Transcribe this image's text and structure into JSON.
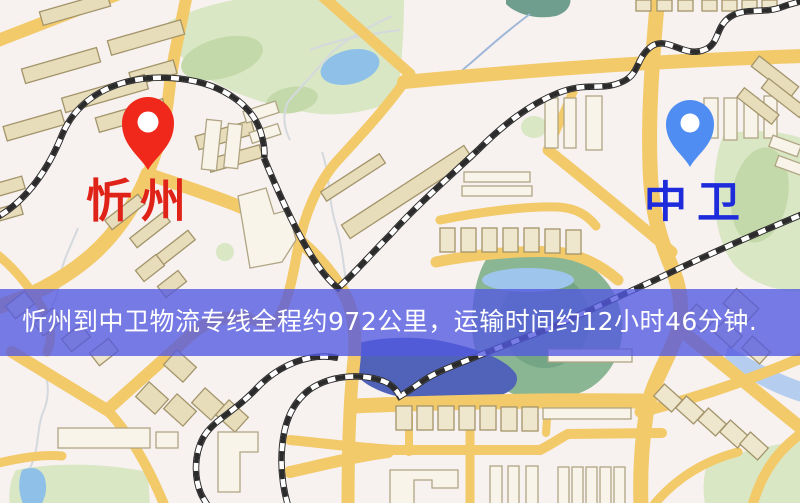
{
  "map": {
    "type": "city-street-map",
    "palette": {
      "background": "#f7f1ef",
      "road": "#f3ca6a",
      "building_fill": "#e7ddbb",
      "building_light": "#f8f4ea",
      "building_outline": "#a3946a",
      "park": "#d9e7c4",
      "park_dark": "#8ab694",
      "pond": "#8fc0e8",
      "lake": "#5063b8",
      "railway": "#2b2b2b"
    }
  },
  "origin_marker": {
    "label": "忻州",
    "label_color": "#e02318",
    "pin_color": "#f0281c"
  },
  "destination_marker": {
    "label": "中卫",
    "label_color": "#1e2bdb",
    "pin_color": "#4f8df2"
  },
  "banner": {
    "text": "忻州到中卫物流专线全程约972公里，运输时间约12小时46分钟.",
    "overlay_color": "#5258e0",
    "text_color": "#ffffff"
  }
}
